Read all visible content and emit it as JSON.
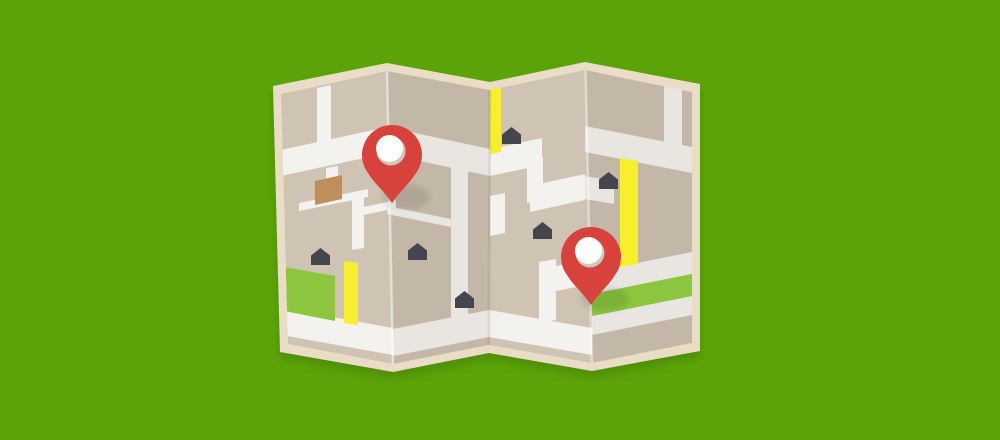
{
  "scene": {
    "type": "flat-illustration",
    "subject": "Folded paper street map with two red location pins on green background",
    "background_color": "#5ba309",
    "map": {
      "panel_count": 4,
      "palette": {
        "border": "#e9ddc6",
        "panel_light": "#cfc4b4",
        "panel_dark": "#c3b7a7",
        "road_light": "#f4f2ef",
        "road_dark": "#e9e6e2",
        "yellow_road": "#f7ee2f",
        "park_green": "#8cc63e",
        "building_brown": "#bf8e5c",
        "house": "#45454d",
        "pin_red": "#d8423c",
        "pin_hole": "#fdfdfc",
        "pin_hole_shadow": "#cfc8b9"
      },
      "houses": [
        {
          "x": 311,
          "y": 248
        },
        {
          "x": 408,
          "y": 243
        },
        {
          "x": 455,
          "y": 291
        },
        {
          "x": 502,
          "y": 127
        },
        {
          "x": 533,
          "y": 222
        },
        {
          "x": 599,
          "y": 172
        }
      ],
      "pins": [
        {
          "id": "pin-1",
          "x": 392,
          "y": 155
        },
        {
          "id": "pin-2",
          "x": 591,
          "y": 257
        }
      ]
    }
  }
}
